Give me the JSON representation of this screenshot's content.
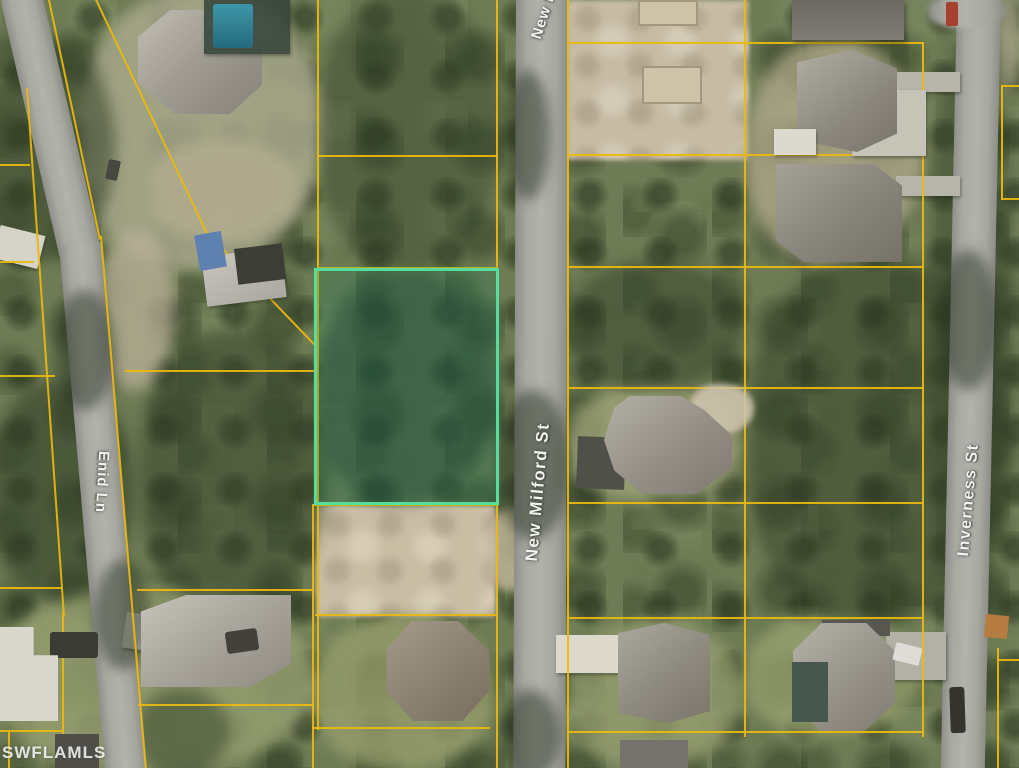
{
  "map": {
    "type": "aerial parcel map",
    "watermark": "SWFLAMLS",
    "streets": {
      "new_milford_top": "New M",
      "new_milford": "New Milford St",
      "enid": "Enid Ln",
      "inverness": "Inverness St"
    },
    "highlighted_parcel_outline_color": "#58dc9c",
    "parcel_line_color": "#ebb90e"
  }
}
